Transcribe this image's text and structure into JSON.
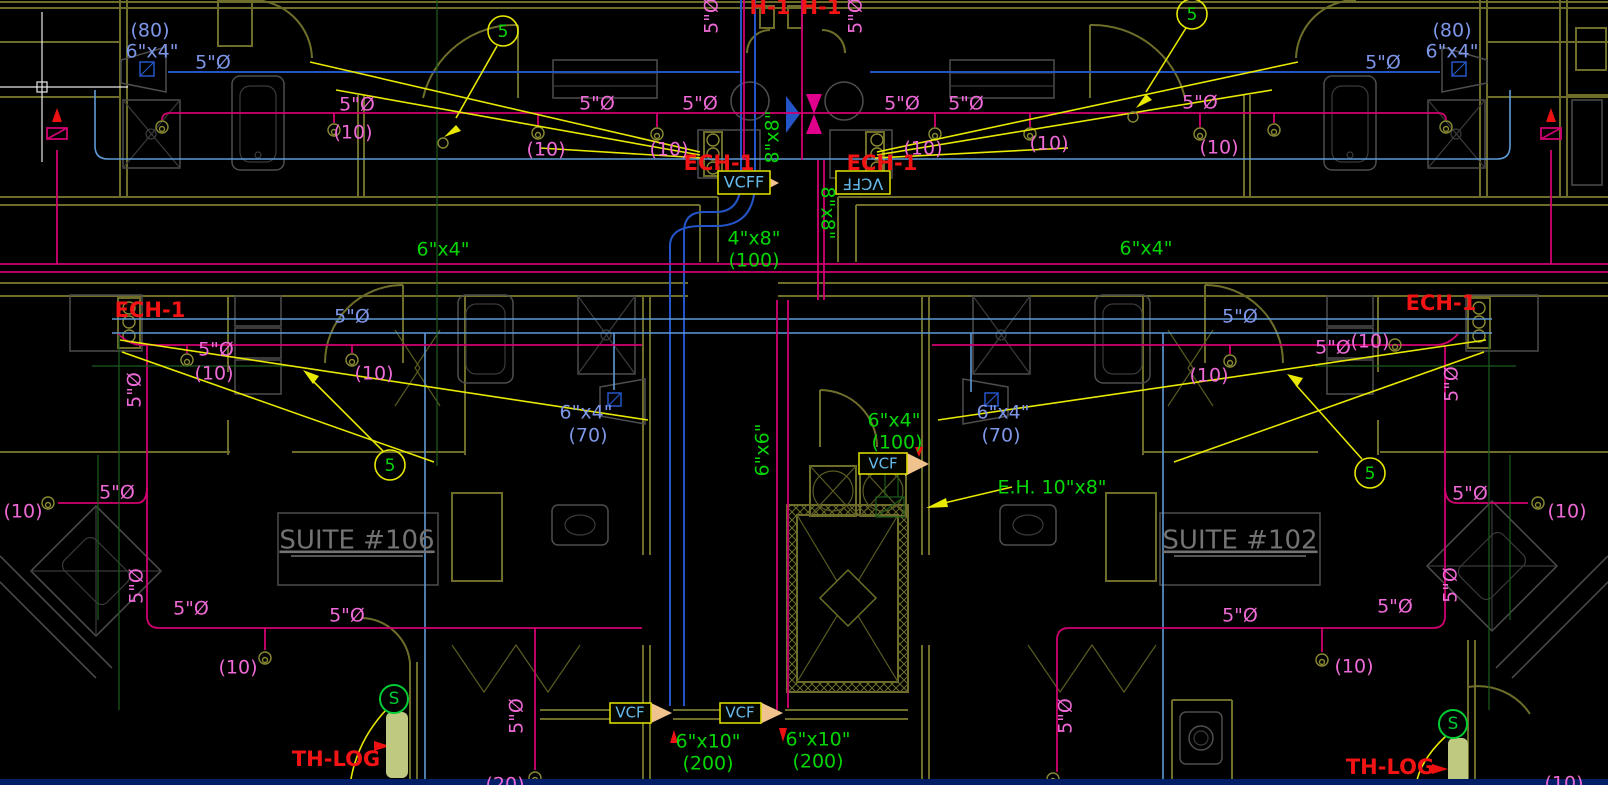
{
  "drawing_type": "HVAC mechanical floor plan",
  "colors": {
    "blueText": "#7d96e8",
    "pink": "#ef6ad6",
    "green": "#06d606",
    "red": "#f21414",
    "cyan": "#66bbee",
    "gray": "#737373",
    "greenS": "#00cc33",
    "yellow": "#e8e800",
    "wall": "#6e6e2a",
    "crimsonLine": "#d10070",
    "darkBlueDuct": "#2455c8",
    "lightBlueDuct": "#5e9bd6",
    "peachDamper": "#f0c28e",
    "thermostatFill": "#bfca80"
  },
  "suites": {
    "left": "SUITE #106",
    "right": "SUITE #102"
  },
  "labels": [
    {
      "n": "dim-80-topleft",
      "t": "(80)",
      "x": 150,
      "y": 31,
      "c": "blueText"
    },
    {
      "n": "dim-6x4-topleft",
      "t": "6\"x4\"",
      "x": 152,
      "y": 52,
      "c": "blueText"
    },
    {
      "n": "dim-5dia-topleft",
      "t": "5\"Ø",
      "x": 213,
      "y": 63,
      "c": "blueText"
    },
    {
      "n": "dim-5dia-topright",
      "t": "5\"Ø",
      "x": 1383,
      "y": 63,
      "c": "blueText"
    },
    {
      "n": "dim-80-topright",
      "t": "(80)",
      "x": 1452,
      "y": 31,
      "c": "blueText"
    },
    {
      "n": "dim-6x4-topright",
      "t": "6\"x4\"",
      "x": 1452,
      "y": 52,
      "c": "blueText"
    },
    {
      "n": "dim-5dia-midleft-blue",
      "t": "5\"Ø",
      "x": 352,
      "y": 317,
      "c": "blueText"
    },
    {
      "n": "dim-5dia-midright-blue",
      "t": "5\"Ø",
      "x": 1240,
      "y": 317,
      "c": "blueText"
    },
    {
      "n": "dim-6x4-sink-left",
      "t": "6\"x4\"",
      "x": 586,
      "y": 413,
      "c": "blueText"
    },
    {
      "n": "dim-70-left",
      "t": "(70)",
      "x": 588,
      "y": 436,
      "c": "blueText"
    },
    {
      "n": "dim-6x4-sink-right",
      "t": "6\"x4\"",
      "x": 1003,
      "y": 413,
      "c": "blueText"
    },
    {
      "n": "dim-70-right",
      "t": "(70)",
      "x": 1001,
      "y": 436,
      "c": "blueText"
    },
    {
      "n": "dim-5dia-t1",
      "t": "5\"Ø",
      "x": 357,
      "y": 105,
      "c": "pink"
    },
    {
      "n": "dim-10-t1",
      "t": "(10)",
      "x": 353,
      "y": 133,
      "c": "pink"
    },
    {
      "n": "dim-5dia-t2",
      "t": "5\"Ø",
      "x": 597,
      "y": 104,
      "c": "pink"
    },
    {
      "n": "dim-10-t2",
      "t": "(10)",
      "x": 546,
      "y": 150,
      "c": "pink"
    },
    {
      "n": "dim-5dia-t3",
      "t": "5\"Ø",
      "x": 700,
      "y": 104,
      "c": "pink"
    },
    {
      "n": "dim-10-t3",
      "t": "(10)",
      "x": 669,
      "y": 150,
      "c": "pink"
    },
    {
      "n": "dim-5dia-t4",
      "t": "5\"Ø",
      "x": 902,
      "y": 104,
      "c": "pink"
    },
    {
      "n": "dim-10-t4",
      "t": "(10)",
      "x": 923,
      "y": 149,
      "c": "pink"
    },
    {
      "n": "dim-5dia-t5",
      "t": "5\"Ø",
      "x": 966,
      "y": 104,
      "c": "pink"
    },
    {
      "n": "dim-10-t5",
      "t": "(10)",
      "x": 1049,
      "y": 144,
      "c": "pink"
    },
    {
      "n": "dim-5dia-t6",
      "t": "5\"Ø",
      "x": 1200,
      "y": 103,
      "c": "pink"
    },
    {
      "n": "dim-10-t6",
      "t": "(10)",
      "x": 1219,
      "y": 148,
      "c": "pink"
    },
    {
      "n": "dim-5dia-riser-l",
      "t": "5\"Ø",
      "x": 712,
      "y": 16,
      "c": "pink",
      "r": -90
    },
    {
      "n": "dim-5dia-riser-r",
      "t": "5\"Ø",
      "x": 856,
      "y": 16,
      "c": "pink",
      "r": -90
    },
    {
      "n": "dim-5dia-m1",
      "t": "5\"Ø",
      "x": 216,
      "y": 350,
      "c": "pink"
    },
    {
      "n": "dim-10-m1",
      "t": "(10)",
      "x": 214,
      "y": 374,
      "c": "pink"
    },
    {
      "n": "dim-10-m2",
      "t": "(10)",
      "x": 374,
      "y": 374,
      "c": "pink"
    },
    {
      "n": "dim-5dia-m2",
      "t": "5\"Ø",
      "x": 135,
      "y": 390,
      "c": "pink",
      "r": -90
    },
    {
      "n": "dim-5dia-m3",
      "t": "5\"Ø",
      "x": 1333,
      "y": 348,
      "c": "pink"
    },
    {
      "n": "dim-10-m3",
      "t": "(10)",
      "x": 1370,
      "y": 342,
      "c": "pink"
    },
    {
      "n": "dim-10-m4",
      "t": "(10)",
      "x": 1209,
      "y": 376,
      "c": "pink"
    },
    {
      "n": "dim-5dia-m4",
      "t": "5\"Ø",
      "x": 1452,
      "y": 384,
      "c": "pink",
      "r": -90
    },
    {
      "n": "dim-10-l1",
      "t": "(10)",
      "x": 23,
      "y": 512,
      "c": "pink"
    },
    {
      "n": "dim-5dia-l1",
      "t": "5\"Ø",
      "x": 117,
      "y": 493,
      "c": "pink"
    },
    {
      "n": "dim-5dia-l2",
      "t": "5\"Ø",
      "x": 137,
      "y": 586,
      "c": "pink",
      "r": -90
    },
    {
      "n": "dim-5dia-l3",
      "t": "5\"Ø",
      "x": 191,
      "y": 609,
      "c": "pink"
    },
    {
      "n": "dim-5dia-l4",
      "t": "5\"Ø",
      "x": 347,
      "y": 616,
      "c": "pink"
    },
    {
      "n": "dim-10-l2",
      "t": "(10)",
      "x": 238,
      "y": 668,
      "c": "pink"
    },
    {
      "n": "dim-5dia-l5",
      "t": "5\"Ø",
      "x": 517,
      "y": 716,
      "c": "pink",
      "r": -90
    },
    {
      "n": "dim-20-bottom",
      "t": "(20)",
      "x": 505,
      "y": 785,
      "c": "pink"
    },
    {
      "n": "dim-5dia-r1",
      "t": "5\"Ø",
      "x": 1240,
      "y": 616,
      "c": "pink"
    },
    {
      "n": "dim-5dia-r2",
      "t": "5\"Ø",
      "x": 1066,
      "y": 716,
      "c": "pink",
      "r": -90
    },
    {
      "n": "dim-10-r1",
      "t": "(10)",
      "x": 1354,
      "y": 667,
      "c": "pink"
    },
    {
      "n": "dim-5dia-r3",
      "t": "5\"Ø",
      "x": 1395,
      "y": 607,
      "c": "pink"
    },
    {
      "n": "dim-5dia-r4",
      "t": "5\"Ø",
      "x": 1451,
      "y": 585,
      "c": "pink",
      "r": -90
    },
    {
      "n": "dim-5dia-r5",
      "t": "5\"Ø",
      "x": 1470,
      "y": 494,
      "c": "pink"
    },
    {
      "n": "dim-10-r2",
      "t": "(10)",
      "x": 1567,
      "y": 512,
      "c": "pink"
    },
    {
      "n": "dim-10-r3",
      "t": "(10)",
      "x": 1564,
      "y": 784,
      "c": "pink"
    },
    {
      "n": "duct-6x4-left",
      "t": "6\"x4\"",
      "x": 443,
      "y": 250,
      "c": "green"
    },
    {
      "n": "duct-6x4-right",
      "t": "6\"x4\"",
      "x": 1146,
      "y": 249,
      "c": "green"
    },
    {
      "n": "duct-4x8",
      "t": "4\"x8\"",
      "x": 754,
      "y": 239,
      "c": "green"
    },
    {
      "n": "duct-4x8-cfm",
      "t": "(100)",
      "x": 754,
      "y": 261,
      "c": "green"
    },
    {
      "n": "duct-8x8-a",
      "t": "8\"x8\"",
      "x": 773,
      "y": 137,
      "c": "green",
      "r": -90
    },
    {
      "n": "duct-8x8-b",
      "t": "8\"x8\"",
      "x": 827,
      "y": 213,
      "c": "green",
      "r": 90
    },
    {
      "n": "duct-6x6",
      "t": "6\"x6\"",
      "x": 763,
      "y": 450,
      "c": "green",
      "r": -90
    },
    {
      "n": "duct-6x4-center",
      "t": "6\"x4\"",
      "x": 894,
      "y": 421,
      "c": "green"
    },
    {
      "n": "duct-6x4-center-cfm",
      "t": "(100)",
      "x": 897,
      "y": 443,
      "c": "green"
    },
    {
      "n": "eh-callout",
      "t": "E.H. 10\"x8\"",
      "x": 1052,
      "y": 488,
      "c": "green"
    },
    {
      "n": "duct-6x10-left",
      "t": "6\"x10\"",
      "x": 708,
      "y": 742,
      "c": "green"
    },
    {
      "n": "duct-6x10-left-cfm",
      "t": "(200)",
      "x": 708,
      "y": 764,
      "c": "green"
    },
    {
      "n": "duct-6x10-right",
      "t": "6\"x10\"",
      "x": 818,
      "y": 740,
      "c": "green"
    },
    {
      "n": "duct-6x10-right-cfm",
      "t": "(200)",
      "x": 818,
      "y": 762,
      "c": "green"
    },
    {
      "n": "sensor-s-left",
      "t": "S",
      "x": 394,
      "y": 699,
      "c": "greenS",
      "s": 17
    },
    {
      "n": "sensor-s-right",
      "t": "S",
      "x": 1453,
      "y": 724,
      "c": "greenS",
      "s": 17
    },
    {
      "n": "keynote-5-topleft",
      "t": "5",
      "x": 503,
      "y": 32,
      "c": "green",
      "s": 17
    },
    {
      "n": "keynote-5-topright",
      "t": "5",
      "x": 1192,
      "y": 15,
      "c": "green",
      "s": 17
    },
    {
      "n": "keynote-5-midleft",
      "t": "5",
      "x": 390,
      "y": 466,
      "c": "green",
      "s": 17
    },
    {
      "n": "keynote-5-midright",
      "t": "5",
      "x": 1370,
      "y": 474,
      "c": "green",
      "s": 17
    },
    {
      "n": "tag-h1-left",
      "t": "H-1",
      "x": 770,
      "y": 8,
      "c": "red",
      "b": 1,
      "s": 21
    },
    {
      "n": "tag-h1-right",
      "t": "H-1",
      "x": 821,
      "y": 8,
      "c": "red",
      "b": 1,
      "s": 21
    },
    {
      "n": "tag-ech1-centerleft",
      "t": "ECH-1",
      "x": 719,
      "y": 164,
      "c": "red",
      "b": 1,
      "s": 21
    },
    {
      "n": "tag-ech1-centerright",
      "t": "ECH-1",
      "x": 882,
      "y": 164,
      "c": "red",
      "b": 1,
      "s": 21
    },
    {
      "n": "tag-ech1-farleft",
      "t": "ECH-1",
      "x": 150,
      "y": 311,
      "c": "red",
      "b": 1,
      "s": 21
    },
    {
      "n": "tag-ech1-farright",
      "t": "ECH-1",
      "x": 1441,
      "y": 304,
      "c": "red",
      "b": 1,
      "s": 21
    },
    {
      "n": "tag-thlog-left",
      "t": "TH-LOG",
      "x": 336,
      "y": 760,
      "c": "red",
      "b": 1,
      "s": 21
    },
    {
      "n": "tag-thlog-right",
      "t": "TH-LOG",
      "x": 1390,
      "y": 768,
      "c": "red",
      "b": 1,
      "s": 21
    },
    {
      "n": "damper-vcff-left",
      "t": "VCFF",
      "x": 744,
      "y": 183,
      "c": "cyan",
      "s": 16
    },
    {
      "n": "damper-vcff-right",
      "t": "VCFF",
      "x": 863,
      "y": 183,
      "c": "cyan",
      "s": 16,
      "r": 180
    },
    {
      "n": "damper-vcf-mid",
      "t": "VCF",
      "x": 883,
      "y": 464,
      "c": "cyan",
      "s": 15
    },
    {
      "n": "damper-vcf-bl",
      "t": "VCF",
      "x": 630,
      "y": 713,
      "c": "cyan",
      "s": 15
    },
    {
      "n": "damper-vcf-br",
      "t": "VCF",
      "x": 740,
      "y": 713,
      "c": "cyan",
      "s": 15
    },
    {
      "n": "suite-106-label",
      "t": "SUITE #106",
      "x": 357,
      "y": 541,
      "c": "gray",
      "s": 26,
      "u": 1
    },
    {
      "n": "suite-102-label",
      "t": "SUITE #102",
      "x": 1240,
      "y": 541,
      "c": "gray",
      "s": 26,
      "u": 1
    }
  ]
}
